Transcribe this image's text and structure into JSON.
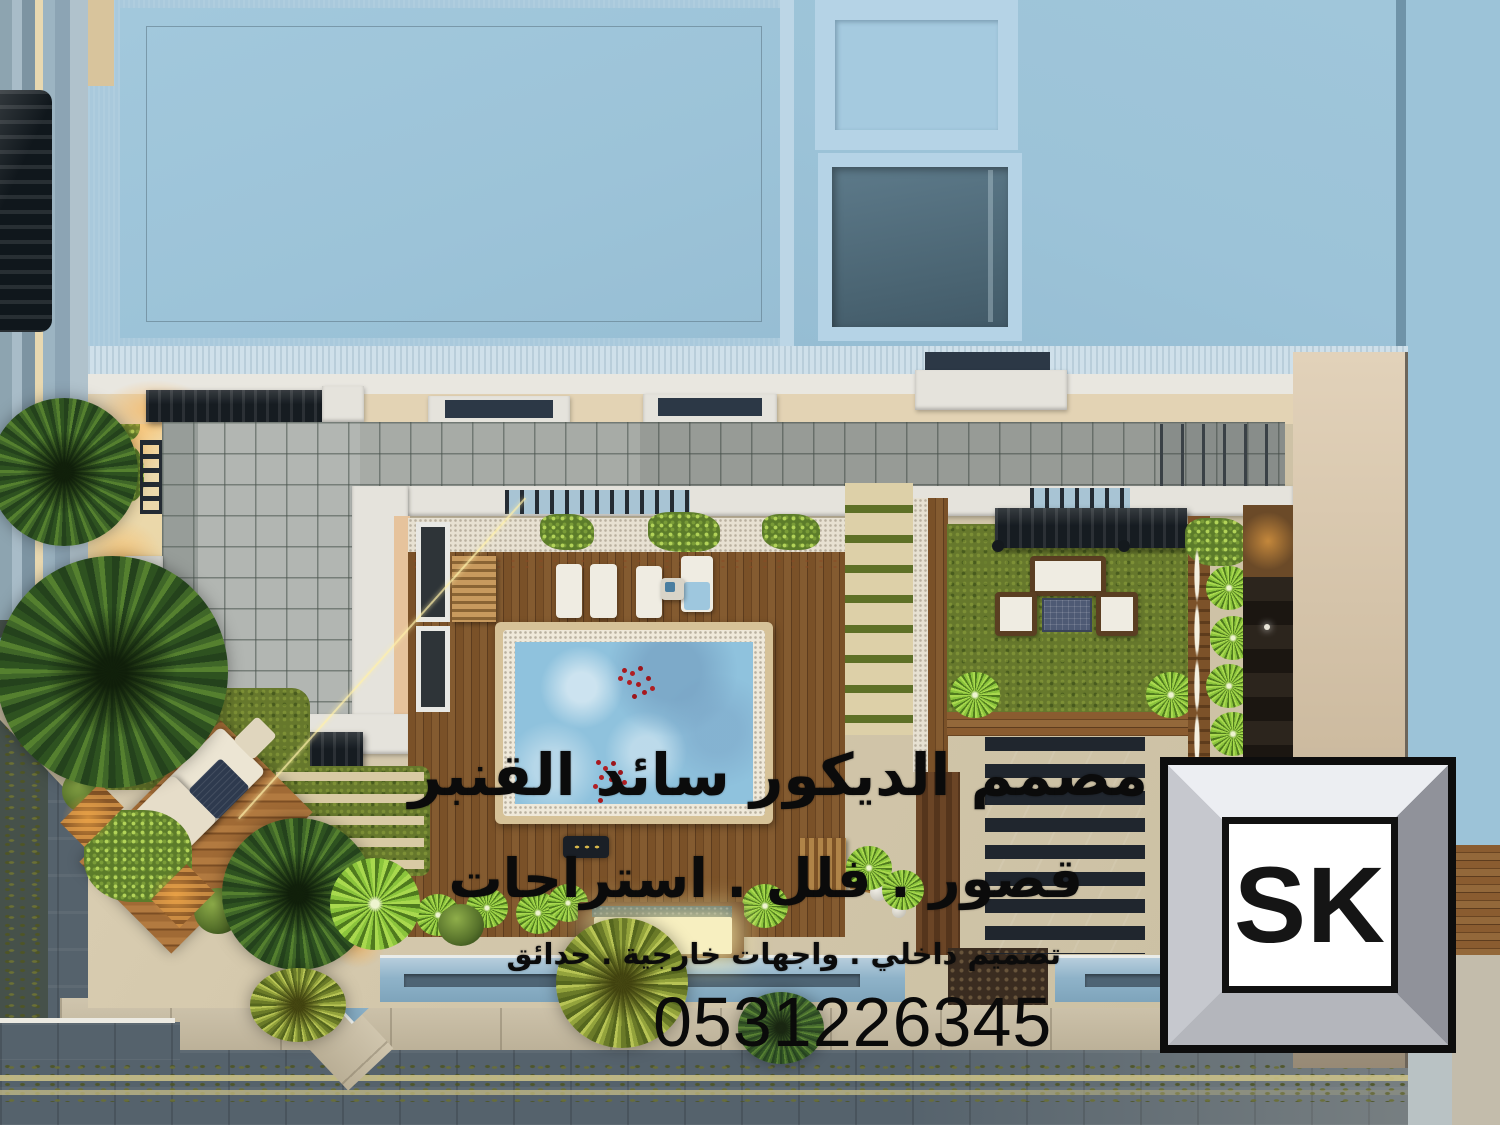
{
  "watermark": {
    "line1": "مصمم الديكور سائد القنبر",
    "line2": "قصور . فلل . استراحات",
    "line3": "تصميم داخلي . واجهات خارجية . حدائق",
    "phone": "0531226345"
  },
  "logo": {
    "text": "SK"
  },
  "palette": {
    "roof_blue": "#9cc3d8",
    "roof_frame_blue": "#a9c9dc",
    "skylight_recess": "#5d7a8a",
    "pool_water": "#8fc2dd",
    "pool_rim_tan": "#d6c298",
    "deck_wood": "#7a5128",
    "grass_green": "#66782c",
    "accent_plant_green": "#9acb3e",
    "terrace_tile_gray": "#a7aba6",
    "parapet_white": "#e5e3dc",
    "court_cream": "#d3c7ab",
    "side_wall_cream": "#d9c2a8",
    "street_gray": "#55626c",
    "lane_line_yellow": "#cfc48a",
    "perimeter_wall_blue": "#8fb3c9",
    "canopy_black": "#161c21",
    "feature_wall_dark": "#241f1a",
    "uplight_orange": "#e8903a",
    "watermark_black": "#0b0b0b",
    "logo_frame_silver": "#c9cbd1"
  }
}
